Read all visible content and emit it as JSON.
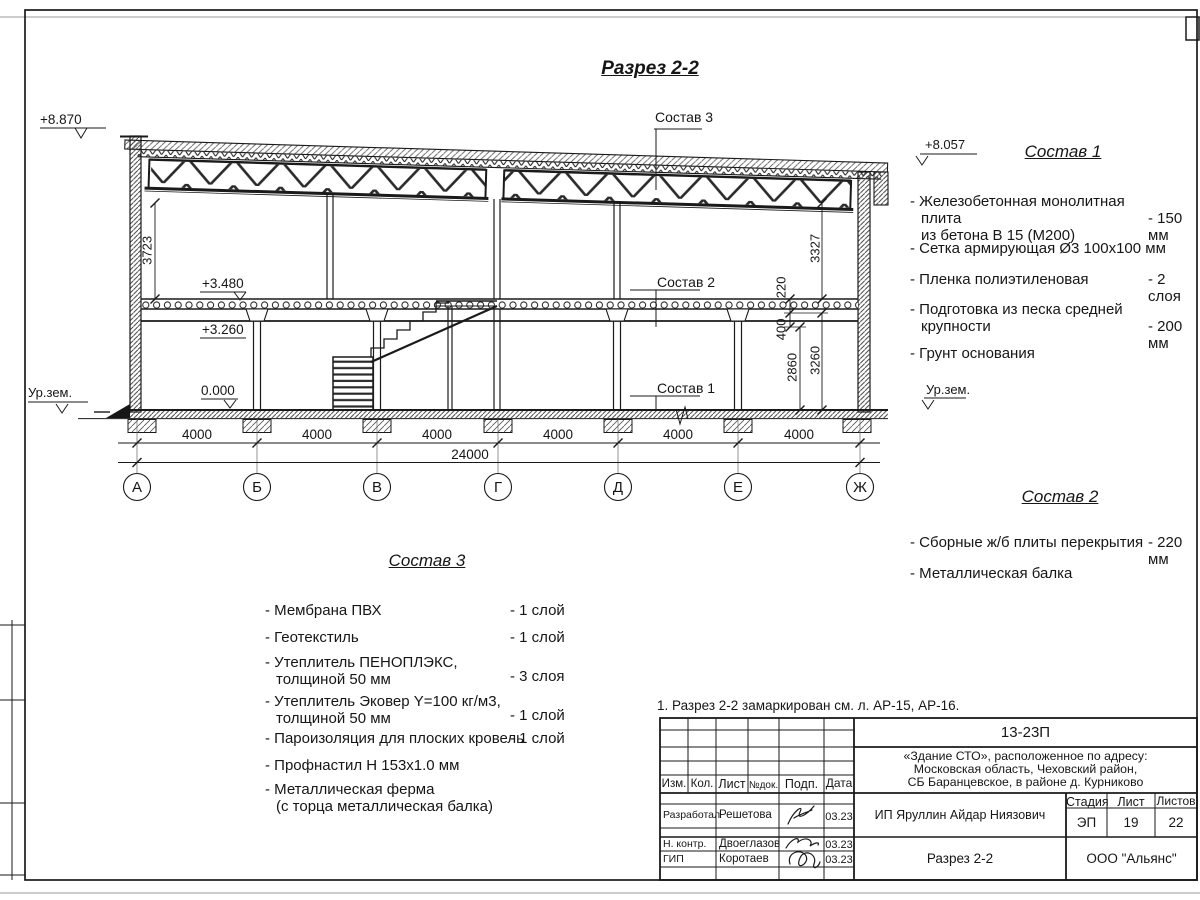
{
  "sheet": {
    "title": "Разрез 2-2",
    "note": "1. Разрез 2-2 замаркирован см. л. АР-15, АР-16."
  },
  "drawing": {
    "axes": [
      "А",
      "Б",
      "В",
      "Г",
      "Д",
      "Е",
      "Ж"
    ],
    "span_dims": [
      "4000",
      "4000",
      "4000",
      "4000",
      "4000",
      "4000"
    ],
    "total_dim": "24000",
    "vdims": {
      "left": "3723",
      "truss_right": "3327",
      "slab": "220",
      "beam": "400",
      "clear": "2860",
      "storey": "3260"
    },
    "elev": {
      "roof_left": "+8.870",
      "roof_right": "+8.057",
      "slab_top": "+3.480",
      "slab_soffit": "+3.260",
      "floor": "0.000",
      "ground_left": "Ур.зем.",
      "ground_right": "Ур.зем."
    },
    "callouts": {
      "c1": "Состав 1",
      "c2": "Состав 2",
      "c3": "Состав 3"
    }
  },
  "sostav1": {
    "heading": "Состав 1",
    "items": [
      {
        "name": "- Железобетонная  монолитная плита\nиз бетона В 15 (М200)",
        "qty": "- 150 мм"
      },
      {
        "name": "- Сетка армирующая Ø3 100х100 мм"
      },
      {
        "name": "- Пленка полиэтиленовая",
        "qty": "- 2 слоя"
      },
      {
        "name": "- Подготовка из песка средней\nкрупности",
        "qty": "- 200 мм"
      },
      {
        "name": "- Грунт основания"
      }
    ]
  },
  "sostav2": {
    "heading": "Состав 2",
    "items": [
      {
        "name": "- Сборные ж/б плиты перекрытия",
        "qty": "- 220 мм"
      },
      {
        "name": "- Металлическая  балка"
      }
    ]
  },
  "sostav3": {
    "heading": "Состав 3",
    "items": [
      {
        "name": "- Мембрана ПВХ",
        "qty": "- 1 слой"
      },
      {
        "name": "- Геотекстиль",
        "qty": "- 1 слой"
      },
      {
        "name": "- Утеплитель ПЕНОПЛЭКС,\nтолщиной 50 мм",
        "qty": "- 3 слоя"
      },
      {
        "name": "- Утеплитель Эковер Y=100 кг/м3,\nтолщиной 50 мм",
        "qty": "- 1 слой"
      },
      {
        "name": "- Пароизоляция для плоских кровель",
        "qty": "- 1 слой"
      },
      {
        "name": "- Профнастил Н 153х1.0 мм"
      },
      {
        "name": "- Металлическая ферма\n(с торца металлическая балка)"
      }
    ]
  },
  "titleblock": {
    "doc_number": "13-23П",
    "project": "«Здание СТО», расположенное по адресу:\nМосковская область, Чеховский район,\nСБ Баранцевское, в районе д. Курниково",
    "col_izm": "Изм.",
    "col_kol": "Кол.",
    "col_list": "Лист",
    "col_ndok": "№док.",
    "col_podp": "Подп.",
    "col_data": "Дата",
    "row1_role": "Разработал",
    "row1_name": "Решетова",
    "row1_date": "03.23",
    "row2_role": "Н. контр.",
    "row2_name": "Двоеглазов",
    "row2_date": "03.23",
    "row3_role": "ГИП",
    "row3_name": "Коротаев",
    "row3_date": "03.23",
    "client": "ИП Яруллин Айдар Ниязович",
    "stage_label": "Стадия",
    "sheet_label": "Лист",
    "sheets_label": "Листов",
    "stage": "ЭП",
    "sheet_no": "19",
    "sheets_total": "22",
    "drawing_title": "Разрез 2-2",
    "company": "ООО \"Альянс\""
  }
}
